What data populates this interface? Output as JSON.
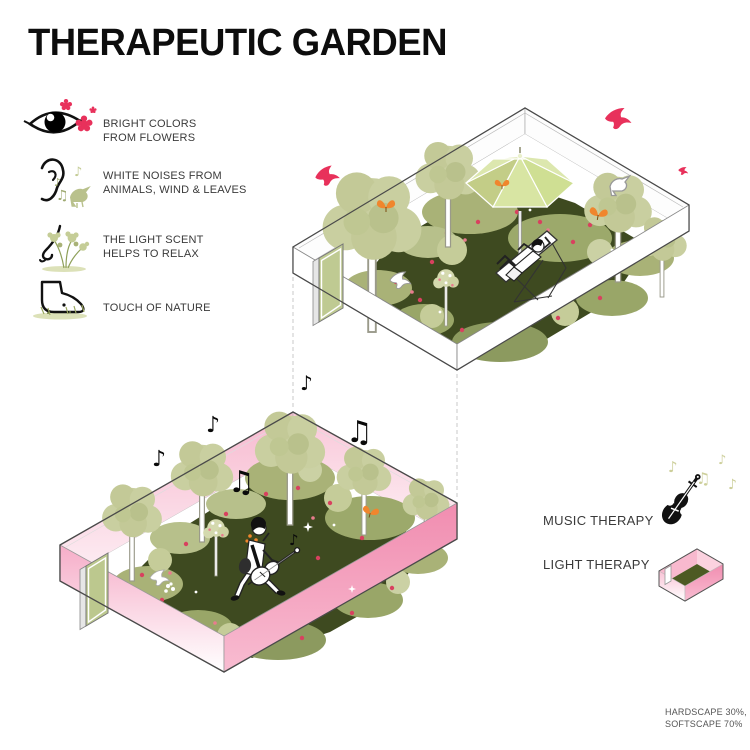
{
  "title": "THERAPEUTIC GARDEN",
  "senses": [
    {
      "icon": "eye-icon",
      "label": "BRIGHT COLORS FROM FLOWERS"
    },
    {
      "icon": "ear-icon",
      "label": "WHITE NOISES FROM ANIMALS, WIND & LEAVES"
    },
    {
      "icon": "nose-icon",
      "label": "THE LIGHT SCENT HELPS TO RELAX"
    },
    {
      "icon": "foot-icon",
      "label": "TOUCH OF NATURE"
    }
  ],
  "therapies": [
    {
      "icon": "violin-icon",
      "label": "MUSIC THERAPY"
    },
    {
      "icon": "light-therapy-box-icon",
      "label": "LIGHT THERAPY"
    }
  ],
  "footnote": {
    "line1": "HARDSCAPE 30%,",
    "line2": "SOFTSCAPE 70%"
  },
  "glyphs": {
    "eighth_note": "♪",
    "beamed_note": "♫"
  },
  "colors": {
    "accent_pink": "#E8315B",
    "wall_pink": "#F39BB9",
    "tree_green": "#C9CFA0",
    "bed_green": "#3E4A20",
    "umbrella_green": "#D8E5A3",
    "flower_red": "#D8415F",
    "butterfly_orange": "#F0862D",
    "note_olive": "#CDCF9B",
    "text_dark": "#3C3C3C",
    "text_gray": "#555555"
  }
}
